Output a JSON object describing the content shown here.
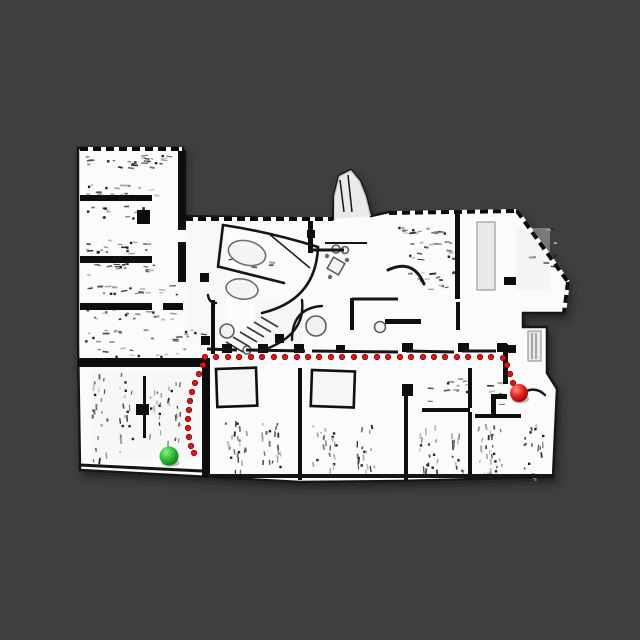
{
  "scene": {
    "width": 640,
    "height": 640,
    "background": "#3f3f3f",
    "colors": {
      "floor": "#fbfbfb",
      "wall": "#0e0e0e",
      "wall_line": "#151515",
      "furniture_gray": "#8f8f8f",
      "light_gray": "#e9e9e9",
      "tint": "#ececec",
      "path_dot_fill": "#e01414",
      "path_dot_edge": "#7d0a0a",
      "start_green_hi": "#8cf08c",
      "start_green_mid": "#2eb82e",
      "start_green_lo": "#0f7a14",
      "goal_red_hi": "#ff8a7a",
      "goal_red_mid": "#e02020",
      "goal_red_lo": "#8f0a0a"
    }
  },
  "map": {
    "outline": "M78,148 L183,148 L183,216 L333,219 L334,196 L339,176 L351,170 L360,181 L366,196 L371,216 L389,212 L517,211 L568,282 L564,313 L523,313 L523,327 L547,327 L547,373 L557,389 L553,477 L400,481 L300,482 L210,477 L80,470 L78,345 Z",
    "blob_tint": "M334,196 L339,176 L351,170 L360,181 L366,196 L371,216 L334,219 Z",
    "tint_rects": [
      [
        516,
        228,
        34,
        62,
        0.35
      ],
      [
        255,
        300,
        48,
        44,
        0.3
      ],
      [
        92,
        372,
        108,
        86,
        0.28
      ],
      [
        186,
        224,
        40,
        120,
        0.22
      ]
    ],
    "walls_rects": [
      [
        178,
        150,
        8,
        80
      ],
      [
        178,
        242,
        8,
        40
      ],
      [
        80,
        195,
        72,
        6
      ],
      [
        80,
        256,
        72,
        7
      ],
      [
        80,
        303,
        72,
        7
      ],
      [
        163,
        303,
        20,
        7
      ],
      [
        78,
        358,
        130,
        9
      ],
      [
        202,
        358,
        8,
        119
      ],
      [
        143,
        376,
        3,
        62
      ],
      [
        136,
        404,
        13,
        11
      ],
      [
        308,
        219,
        5,
        34
      ],
      [
        211,
        300,
        4,
        54
      ],
      [
        350,
        298,
        4,
        32
      ],
      [
        455,
        214,
        5,
        85
      ],
      [
        456,
        302,
        4,
        28
      ],
      [
        385,
        319,
        36,
        5
      ],
      [
        298,
        368,
        4,
        112
      ],
      [
        404,
        388,
        4,
        92
      ],
      [
        402,
        384,
        11,
        12
      ],
      [
        468,
        368,
        4,
        40
      ],
      [
        468,
        412,
        4,
        68
      ],
      [
        422,
        408,
        48,
        4
      ],
      [
        503,
        344,
        5,
        40
      ],
      [
        475,
        414,
        46,
        4
      ],
      [
        491,
        394,
        16,
        5
      ],
      [
        491,
        394,
        5,
        20
      ],
      [
        137,
        210,
        13,
        14
      ],
      [
        504,
        277,
        12,
        8
      ],
      [
        222,
        344,
        10,
        9
      ],
      [
        258,
        344,
        10,
        9
      ],
      [
        294,
        344,
        10,
        9
      ],
      [
        336,
        345,
        9,
        8
      ],
      [
        402,
        343,
        11,
        9
      ],
      [
        458,
        343,
        11,
        9
      ],
      [
        497,
        343,
        10,
        9
      ],
      [
        508,
        345,
        8,
        8
      ],
      [
        200,
        273,
        9,
        9
      ],
      [
        201,
        336,
        9,
        9
      ],
      [
        275,
        334,
        9,
        9
      ],
      [
        307,
        230,
        8,
        8
      ]
    ],
    "wall_lines": [
      [
        310,
        250,
        344,
        250,
        3
      ],
      [
        352,
        299,
        398,
        299,
        3
      ],
      [
        325,
        243,
        367,
        243,
        2
      ],
      [
        268,
        233,
        310,
        268,
        1.5
      ],
      [
        80,
        465,
        202,
        471,
        3
      ],
      [
        208,
        476,
        552,
        476,
        4
      ],
      [
        207,
        349,
        237,
        350,
        3
      ],
      [
        246,
        350,
        305,
        351,
        3
      ],
      [
        312,
        351,
        398,
        352,
        3
      ],
      [
        406,
        351,
        454,
        352,
        3
      ],
      [
        462,
        351,
        496,
        351,
        3
      ],
      [
        340,
        180,
        344,
        212,
        1.5
      ],
      [
        348,
        175,
        352,
        212,
        1.5
      ]
    ],
    "wall_paths": [
      [
        "M223,225 Q270,232 318,247",
        2.6
      ],
      [
        "M318,247 Q316,300 262,313",
        2.6
      ],
      [
        "M223,225 L218,267",
        2.6
      ],
      [
        "M220,267 L284,283",
        2.6
      ],
      [
        "M302,300 Q306,334 266,349",
        2.4
      ],
      [
        "M292,340 Q292,308 322,306",
        2.4
      ],
      [
        "M524,392 Q536,386 545,395",
        2.4
      ],
      [
        "M388,270 Q413,258 424,284",
        3
      ],
      [
        "M216,303 Q209,303 208,295",
        2.4
      ]
    ],
    "windows": [
      [
        80,
        149,
        182,
        149
      ],
      [
        185,
        219,
        333,
        219
      ],
      [
        389,
        213,
        516,
        211
      ],
      [
        517,
        211,
        568,
        282
      ],
      [
        568,
        282,
        564,
        313
      ]
    ],
    "stair_lines": [
      [
        226,
        342,
        243,
        352
      ],
      [
        233,
        337,
        250,
        347
      ],
      [
        240,
        332,
        257,
        342
      ],
      [
        247,
        327,
        264,
        337
      ],
      [
        254,
        322,
        271,
        332
      ],
      [
        261,
        317,
        278,
        327
      ]
    ],
    "furniture": {
      "ellipses": [
        [
          247,
          253,
          19,
          12,
          15
        ],
        [
          242,
          289,
          16,
          10,
          8
        ]
      ],
      "circles": [
        [
          316,
          326,
          10
        ],
        [
          336,
          249,
          4
        ],
        [
          345,
          250,
          3.5
        ],
        [
          380,
          327,
          5.5
        ],
        [
          227,
          331,
          7
        ],
        [
          247,
          350,
          4
        ]
      ],
      "tables": [
        [
          216,
          369,
          40,
          38,
          -2
        ],
        [
          312,
          370,
          43,
          36,
          2
        ]
      ],
      "square_table": {
        "cx": 336,
        "cy": 266,
        "size": 13,
        "rot": 30,
        "chairs": [
          [
            327,
            256
          ],
          [
            347,
            260
          ],
          [
            330,
            277
          ]
        ]
      },
      "light_rects": [
        [
          477,
          222,
          18,
          68
        ],
        [
          528,
          331,
          13,
          30
        ]
      ],
      "door_stripes": [
        [
          532,
          333,
          532,
          359
        ],
        [
          536,
          333,
          536,
          359
        ]
      ],
      "speckles": [
        [
          84,
          152,
          88,
          16,
          26,
          "h",
          1
        ],
        [
          84,
          184,
          70,
          12,
          18,
          "h",
          2
        ],
        [
          84,
          206,
          70,
          12,
          16,
          "h",
          3
        ],
        [
          84,
          240,
          70,
          14,
          20,
          "h",
          4
        ],
        [
          84,
          264,
          72,
          12,
          16,
          "h",
          5
        ],
        [
          84,
          284,
          96,
          12,
          18,
          "h",
          6
        ],
        [
          84,
          309,
          92,
          12,
          18,
          "h",
          7
        ],
        [
          84,
          330,
          118,
          12,
          22,
          "h",
          8
        ],
        [
          88,
          348,
          100,
          9,
          12,
          "h",
          9
        ],
        [
          92,
          372,
          15,
          88,
          20,
          "v",
          10
        ],
        [
          118,
          372,
          15,
          86,
          18,
          "v",
          11
        ],
        [
          150,
          374,
          13,
          62,
          14,
          "v",
          12
        ],
        [
          168,
          376,
          15,
          78,
          16,
          "v",
          13
        ],
        [
          226,
          420,
          22,
          50,
          22,
          "v",
          14
        ],
        [
          260,
          420,
          22,
          50,
          20,
          "v",
          15
        ],
        [
          312,
          424,
          24,
          46,
          20,
          "v",
          16
        ],
        [
          354,
          424,
          22,
          46,
          18,
          "v",
          17
        ],
        [
          418,
          424,
          20,
          48,
          18,
          "v",
          18
        ],
        [
          450,
          428,
          16,
          44,
          14,
          "v",
          19
        ],
        [
          478,
          420,
          16,
          54,
          16,
          "v",
          20
        ],
        [
          489,
          424,
          16,
          50,
          14,
          "v",
          21
        ],
        [
          524,
          422,
          20,
          54,
          18,
          "v",
          22
        ],
        [
          395,
          223,
          55,
          12,
          14,
          "h",
          23
        ],
        [
          408,
          240,
          46,
          22,
          16,
          "h",
          24
        ],
        [
          408,
          272,
          46,
          20,
          14,
          "h",
          25
        ],
        [
          222,
          244,
          60,
          24,
          10,
          "h",
          26
        ],
        [
          315,
          372,
          36,
          30,
          10,
          "h",
          27
        ],
        [
          218,
          372,
          34,
          32,
          8,
          "h",
          28
        ],
        [
          426,
          374,
          40,
          28,
          12,
          "h",
          29
        ],
        [
          480,
          380,
          26,
          26,
          8,
          "h",
          30
        ],
        [
          528,
          228,
          26,
          44,
          8,
          "h",
          31
        ]
      ]
    }
  },
  "path": {
    "dot_radius": 2.7,
    "waypoints": [
      [
        205,
        357
      ],
      [
        216,
        357
      ],
      [
        228,
        357
      ],
      [
        239,
        357
      ],
      [
        251,
        357
      ],
      [
        262,
        357
      ],
      [
        274,
        357
      ],
      [
        285,
        357
      ],
      [
        297,
        357
      ],
      [
        308,
        357
      ],
      [
        319,
        357
      ],
      [
        331,
        357
      ],
      [
        342,
        357
      ],
      [
        354,
        357
      ],
      [
        365,
        357
      ],
      [
        377,
        357
      ],
      [
        388,
        357
      ],
      [
        400,
        357
      ],
      [
        411,
        357
      ],
      [
        423,
        357
      ],
      [
        434,
        357
      ],
      [
        445,
        357
      ],
      [
        457,
        357
      ],
      [
        468,
        357
      ],
      [
        480,
        357
      ],
      [
        491,
        357
      ],
      [
        503,
        358
      ],
      [
        507,
        365
      ],
      [
        510,
        374
      ],
      [
        513,
        383
      ],
      [
        203,
        365
      ],
      [
        199,
        374
      ],
      [
        195,
        383
      ],
      [
        192,
        392
      ],
      [
        190,
        401
      ],
      [
        189,
        410
      ],
      [
        188,
        419
      ],
      [
        188,
        428
      ],
      [
        189,
        437
      ],
      [
        191,
        446
      ],
      [
        194,
        453
      ]
    ]
  },
  "markers": {
    "start": {
      "x": 169,
      "y": 456,
      "r": 9.5,
      "label": "start"
    },
    "goal": {
      "x": 519,
      "y": 393,
      "r": 9,
      "label": "goal"
    }
  }
}
